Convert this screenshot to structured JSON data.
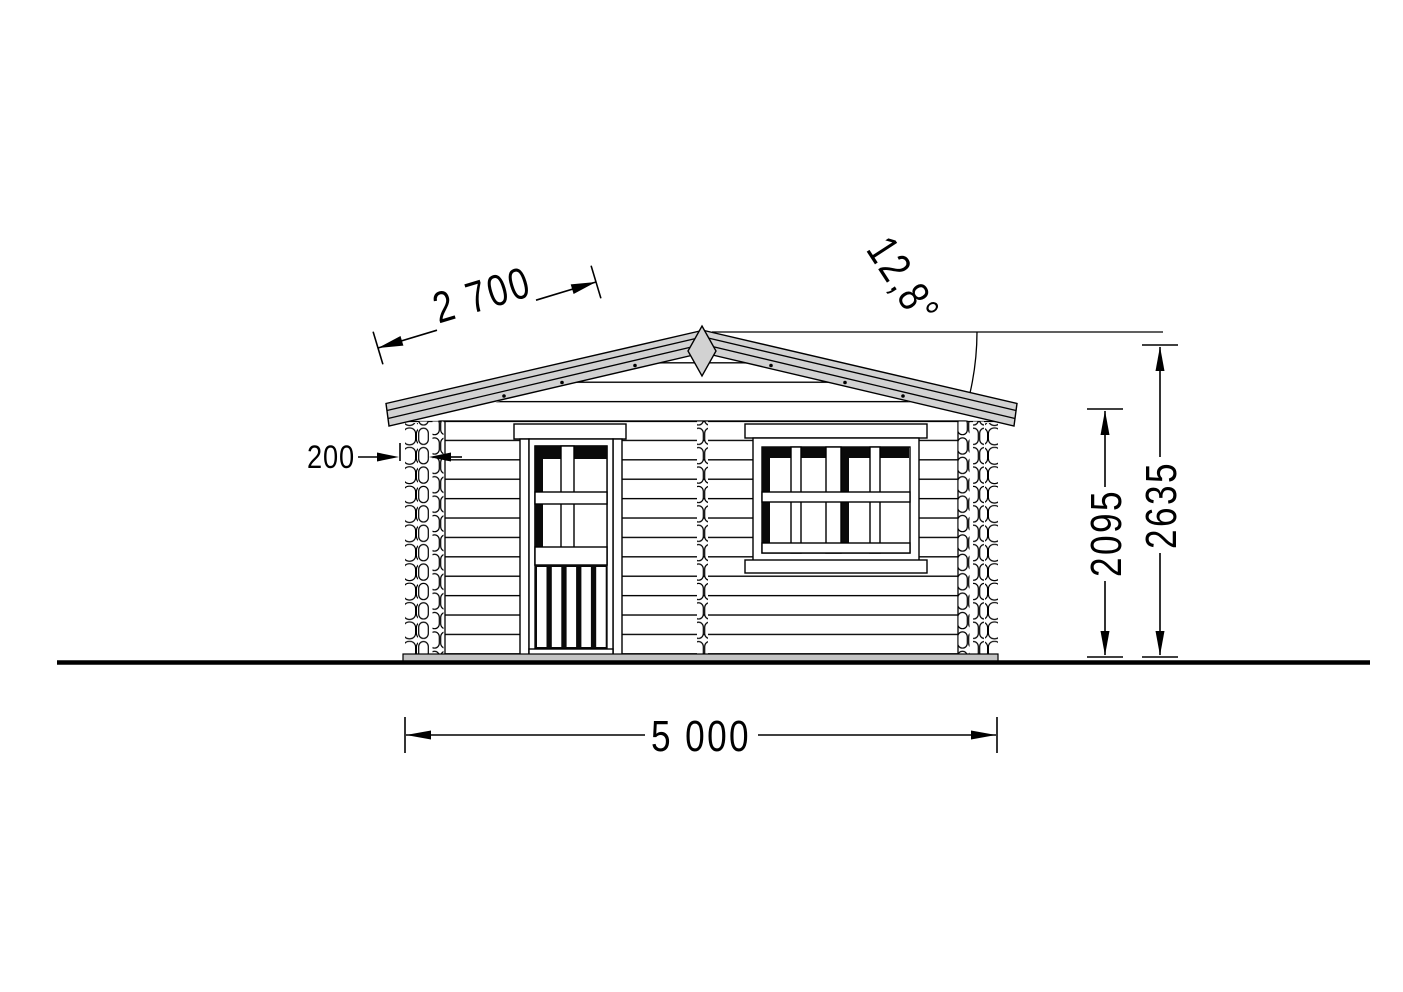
{
  "drawing": {
    "type": "front-elevation",
    "annotations": {
      "slope_length": {
        "value": "2 700",
        "unit": "mm",
        "target": "roof-slope"
      },
      "roof_angle": {
        "value": "12,8°",
        "target": "roof-pitch"
      },
      "log_thickness": {
        "value": "200",
        "unit": "mm",
        "target": "corner-log-protrusion"
      },
      "wall_height": {
        "value": "2095",
        "unit": "mm",
        "target": "ground-to-eave"
      },
      "ridge_height": {
        "value": "2635",
        "unit": "mm",
        "target": "ground-to-ridge"
      },
      "total_width": {
        "value": "5 000",
        "unit": "mm",
        "target": "facade-width"
      }
    },
    "colors": {
      "background": "#ffffff",
      "line": "#000000",
      "roof_fill": "#d2d2d2",
      "finial_fill": "#d2d2d2",
      "foundation_fill": "#c4c4c4",
      "threshold_fill": "#8c8c8c",
      "shadow_fill": "#0a0a0a"
    }
  }
}
